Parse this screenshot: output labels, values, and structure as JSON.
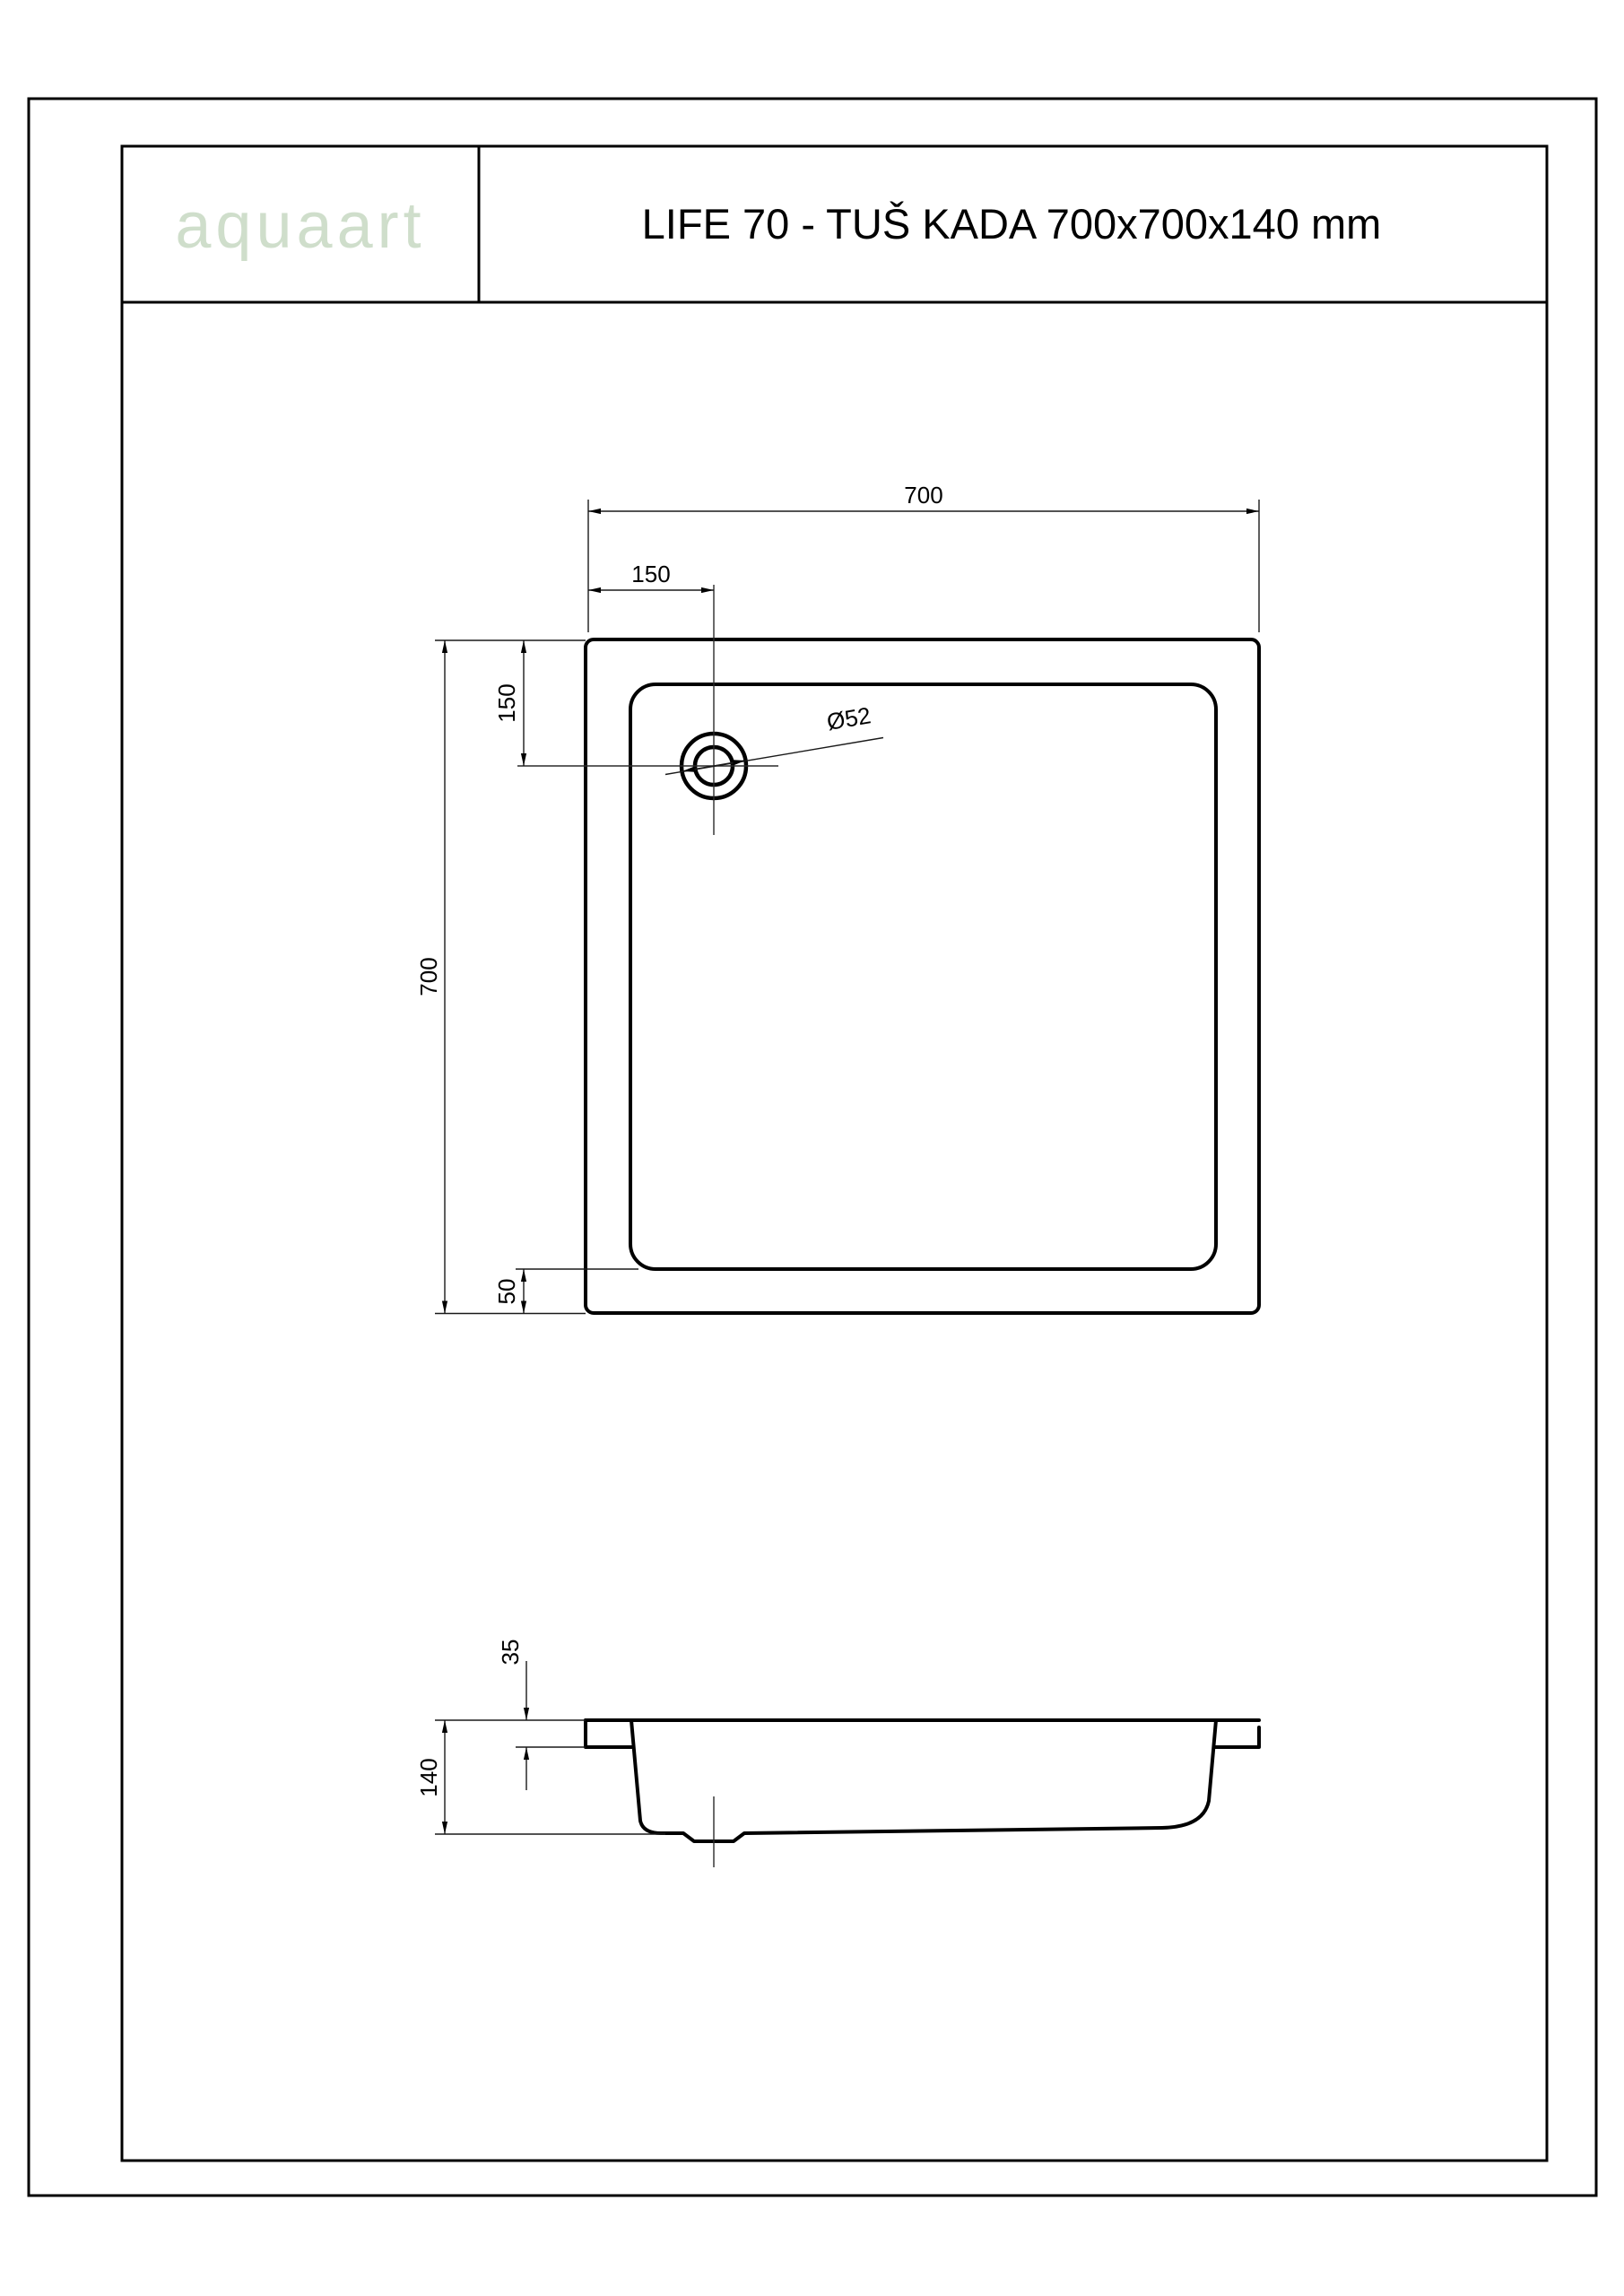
{
  "header": {
    "logo_text": "aquaart",
    "logo_bg": "#4c5566",
    "logo_color": "#cfdecb",
    "title": "LIFE 70 - TUŠ KADA 700x700x140 mm"
  },
  "drawing": {
    "top_view": {
      "width_label": "700",
      "height_label": "700",
      "drain_offset_x_label": "150",
      "drain_offset_y_label": "150",
      "bottom_inset_label": "50",
      "drain_diameter_label": "Ø52"
    },
    "side_view": {
      "rim_depth_label": "35",
      "total_height_label": "140"
    }
  }
}
